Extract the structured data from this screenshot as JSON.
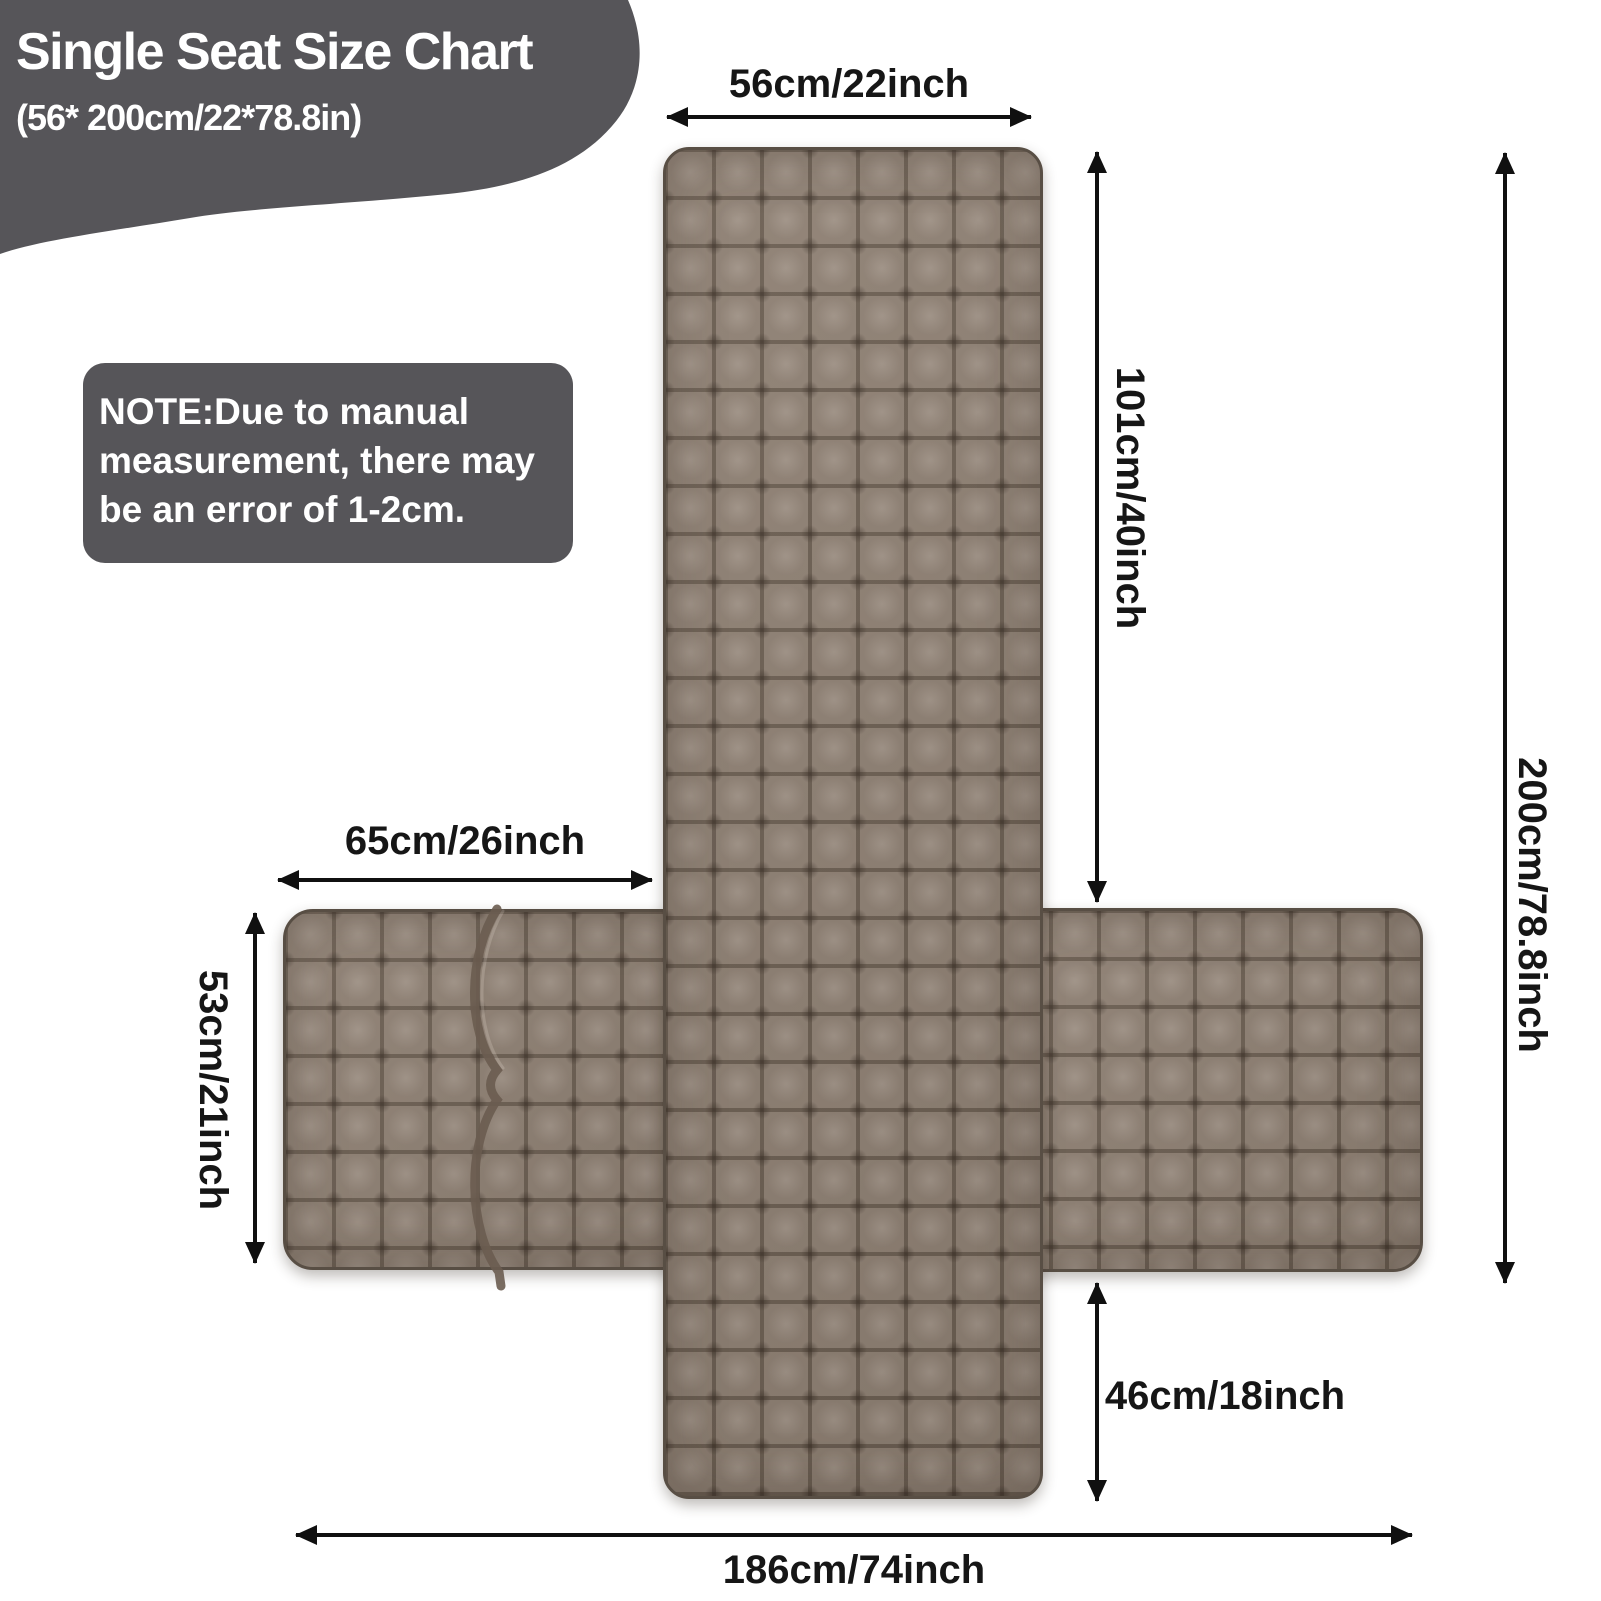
{
  "title_block": {
    "title": "Single Seat Size Chart",
    "subtitle": "(56* 200cm/22*78.8in)"
  },
  "note": {
    "text": "NOTE:Due to manual measurement, there may be an error of 1-2cm."
  },
  "labels": {
    "top_width": "56cm/22inch",
    "backrest_height": "101cm/40inch",
    "total_length": "200cm/78.8inch",
    "left_arm_width": "65cm/26inch",
    "left_arm_height": "53cm/21inch",
    "front_drop": "46cm/18inch",
    "total_width": "186cm/74inch"
  },
  "colors": {
    "panel_gray": "#565559",
    "fabric_base": "#8e8073",
    "fabric_seam": "#6a5c50",
    "fabric_edge": "#584e44",
    "arrow_black": "#101010",
    "text_dark": "#161616",
    "text_light": "#ffffff"
  }
}
